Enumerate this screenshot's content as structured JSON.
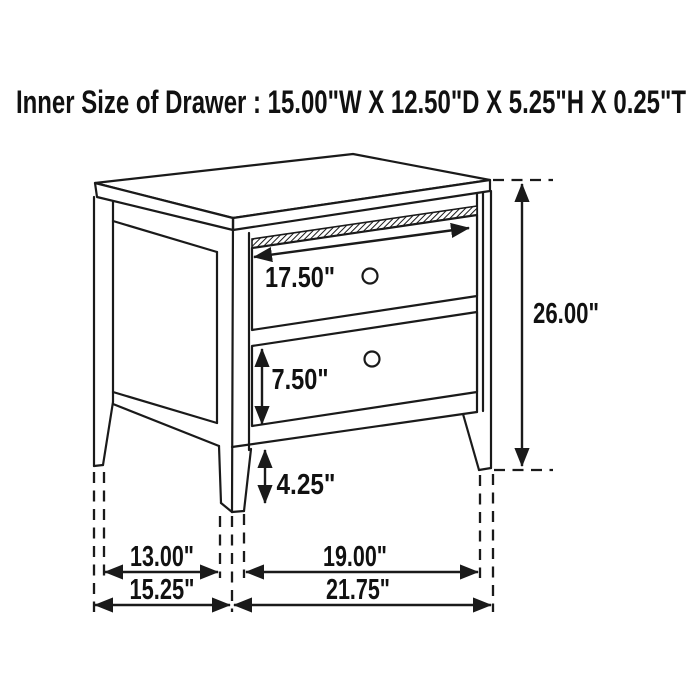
{
  "title": "Inner Size of Drawer : 15.00\"W X 12.50\"D X 5.25\"H X 0.25\"T",
  "figure": {
    "kind": "furniture dimension line drawing",
    "item": "two-drawer nightstand",
    "drawer_count": 2
  },
  "colors": {
    "ink": "#1a1a1a",
    "background": "#ffffff"
  },
  "dims": {
    "drawer_face_width": "17.50\"",
    "overall_height": "26.00\"",
    "drawer_face_height": "7.50\"",
    "leg_height": "4.25\"",
    "side_leg_span": "13.00\"",
    "front_leg_span": "19.00\"",
    "overall_depth": "15.25\"",
    "overall_width": "21.75\""
  }
}
